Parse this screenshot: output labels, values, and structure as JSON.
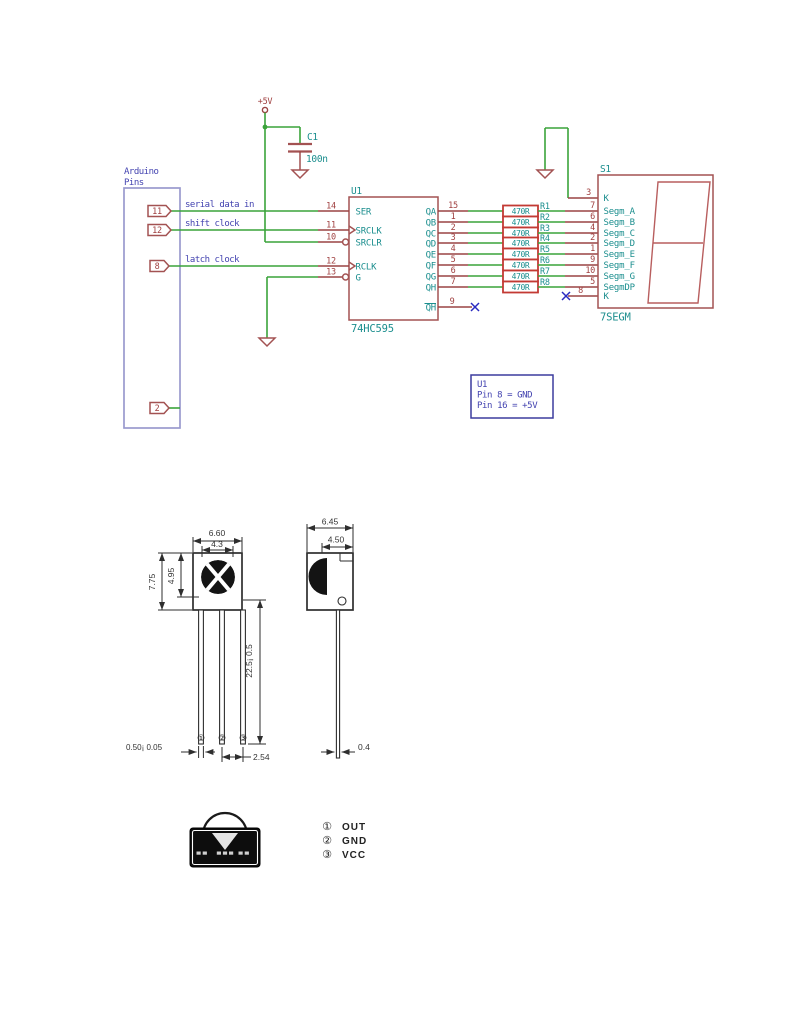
{
  "page": {
    "background": "#ffffff"
  },
  "schematic": {
    "colors": {
      "wire_green": "#3aa33a",
      "symbol_red": "#a35252",
      "resistor_red": "#c33a34",
      "pin_name_teal": "#1b8e8e",
      "label_blue": "#4343b0",
      "noconnect_blue": "#2a2ac0",
      "arduino_box_blue": "#9a9ace"
    },
    "power": {
      "vcc_label": "+5V",
      "cap_ref": "C1",
      "cap_value": "100n"
    },
    "arduino": {
      "title_line1": "Arduino",
      "title_line2": "Pins",
      "pins": [
        {
          "number": "11",
          "label": "serial data in"
        },
        {
          "number": "12",
          "label": "shift clock"
        },
        {
          "number": "8",
          "label": "latch clock"
        },
        {
          "number": "2",
          "label": ""
        }
      ]
    },
    "u1": {
      "reference": "U1",
      "value": "74HC595",
      "left_pins": [
        {
          "number": "14",
          "name": "SER"
        },
        {
          "number": "11",
          "name": "SRCLK"
        },
        {
          "number": "10",
          "name": "SRCLR"
        },
        {
          "number": "12",
          "name": "RCLK"
        },
        {
          "number": "13",
          "name": "G"
        }
      ],
      "right_pins": [
        {
          "number": "15",
          "name": "QA"
        },
        {
          "number": "1",
          "name": "QB"
        },
        {
          "number": "2",
          "name": "QC"
        },
        {
          "number": "3",
          "name": "QD"
        },
        {
          "number": "4",
          "name": "QE"
        },
        {
          "number": "5",
          "name": "QF"
        },
        {
          "number": "6",
          "name": "QG"
        },
        {
          "number": "7",
          "name": "QH"
        }
      ],
      "qh_bar": {
        "number": "9",
        "name": "QH"
      }
    },
    "resistors": [
      {
        "ref": "R1",
        "value": "470R"
      },
      {
        "ref": "R2",
        "value": "470R"
      },
      {
        "ref": "R3",
        "value": "470R"
      },
      {
        "ref": "R4",
        "value": "470R"
      },
      {
        "ref": "R5",
        "value": "470R"
      },
      {
        "ref": "R6",
        "value": "470R"
      },
      {
        "ref": "R7",
        "value": "470R"
      },
      {
        "ref": "R8",
        "value": "470R"
      }
    ],
    "display": {
      "reference": "S1",
      "value": "7SEGM",
      "pins": [
        {
          "number": "3",
          "name": "K"
        },
        {
          "number": "7",
          "name": "Segm_A"
        },
        {
          "number": "6",
          "name": "Segm_B"
        },
        {
          "number": "4",
          "name": "Segm_C"
        },
        {
          "number": "2",
          "name": "Segm_D"
        },
        {
          "number": "1",
          "name": "Segm_E"
        },
        {
          "number": "9",
          "name": "Segm_F"
        },
        {
          "number": "10",
          "name": "Segm_G"
        },
        {
          "number": "5",
          "name": "SegmDP"
        },
        {
          "number": "8",
          "name": "K"
        }
      ]
    },
    "note": {
      "line1": "U1",
      "line2": "Pin 8 = GND",
      "line3": "Pin 16 = +5V"
    }
  },
  "drawing": {
    "front": {
      "width_total": "6.60",
      "width_lens": "4.3",
      "height_total": "7.75",
      "height_lens": "4.95",
      "lead_length": "22.5¡ 0.5",
      "lead_width": "0.50¡ 0.05",
      "pitch": "2.54",
      "pin_marks": [
        "①",
        "②",
        "③"
      ]
    },
    "side": {
      "width_total": "6.45",
      "width_lens": "4.50",
      "lead_thickness": "0.4"
    },
    "pinout": {
      "rows": [
        {
          "mark": "①",
          "label": "OUT"
        },
        {
          "mark": "②",
          "label": "GND"
        },
        {
          "mark": "③",
          "label": "VCC"
        }
      ]
    }
  }
}
